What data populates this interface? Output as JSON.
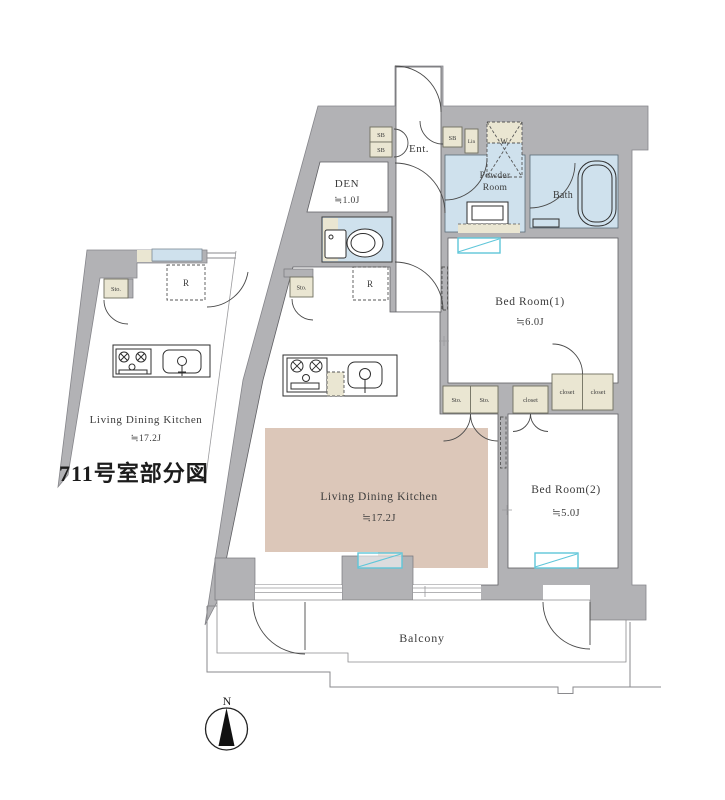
{
  "title": "711号室部分図",
  "compass": {
    "north": "N"
  },
  "inset": {
    "ldk_name": "Living Dining Kitchen",
    "ldk_area": "≒17.2J",
    "storage": "Sto.",
    "fridge": "R"
  },
  "plan": {
    "entrance": "Ent.",
    "den_name": "DEN",
    "den_area": "≒1.0J",
    "powder_line1": "Powder",
    "powder_line2": "Room",
    "bath": "Bath",
    "washer": "W",
    "shoe_box": "SB",
    "linen": "Lin",
    "storage": "Sto.",
    "closet": "closet",
    "fridge": "R",
    "bedroom1_name": "Bed Room(1)",
    "bedroom1_area": "≒6.0J",
    "bedroom2_name": "Bed Room(2)",
    "bedroom2_area": "≒5.0J",
    "ldk_name": "Living Dining Kitchen",
    "ldk_area": "≒17.2J",
    "balcony": "Balcony"
  },
  "colors": {
    "wall": "#b2b2b5",
    "wet_room": "#cfe1ed",
    "storage_box": "#eae6d2",
    "ldk_highlight": "#dcc7b9",
    "window": "#5fc6d9"
  }
}
